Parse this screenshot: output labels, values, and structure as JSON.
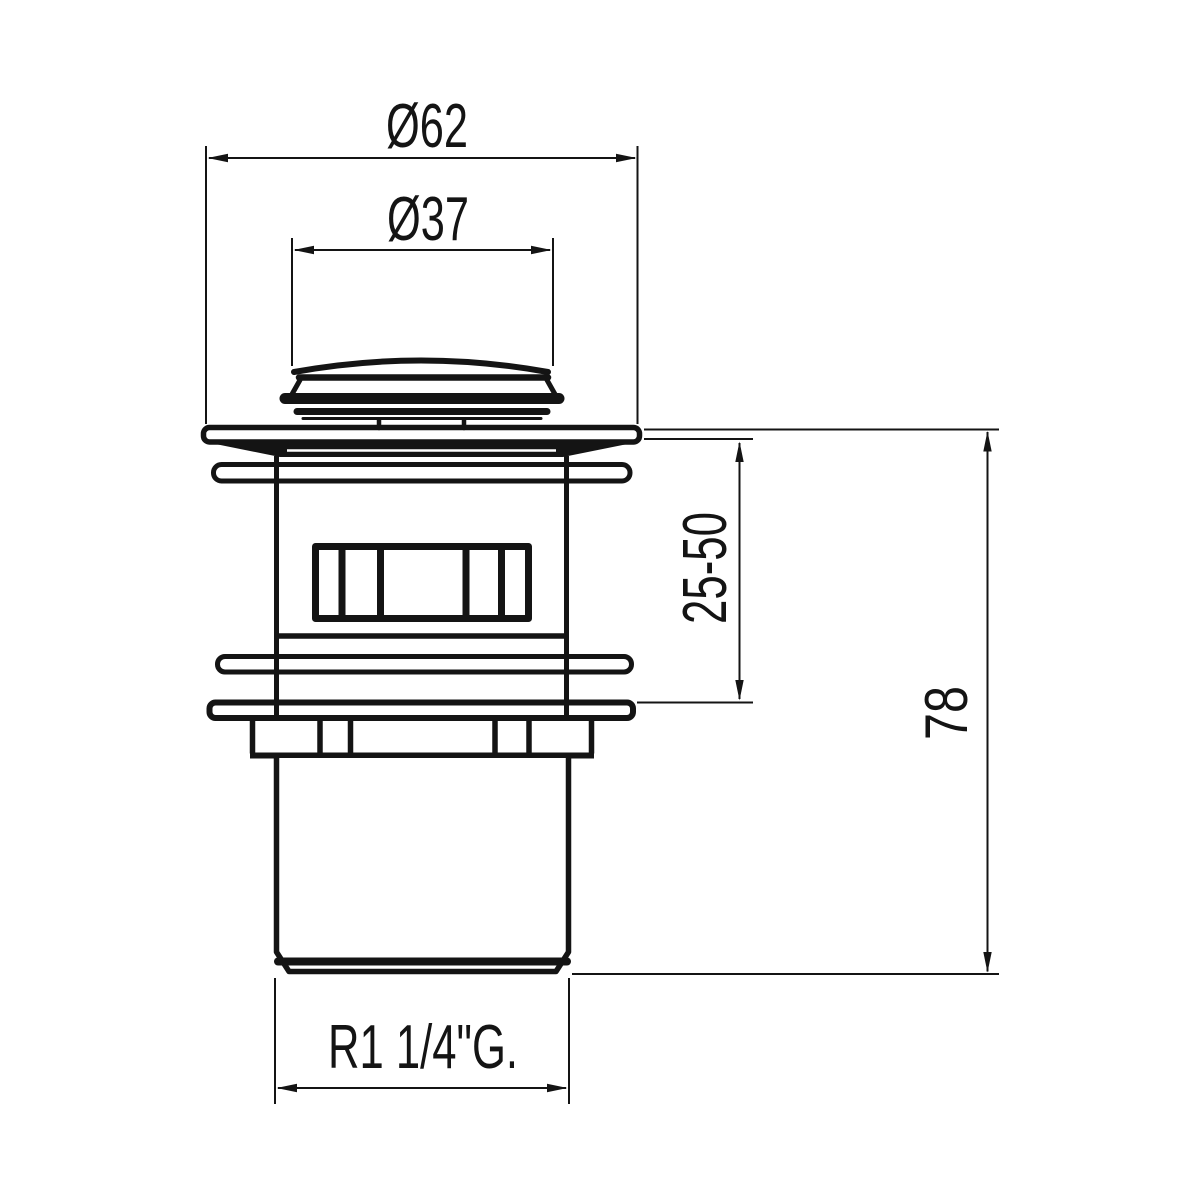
{
  "drawing": {
    "background": "#ffffff",
    "line_color": "#141414",
    "labels": {
      "outer_diameter": "Ø62",
      "cap_diameter": "Ø37",
      "clamp_range": "25-50",
      "overall_height": "78",
      "thread": "R1 1/4\"G."
    }
  }
}
